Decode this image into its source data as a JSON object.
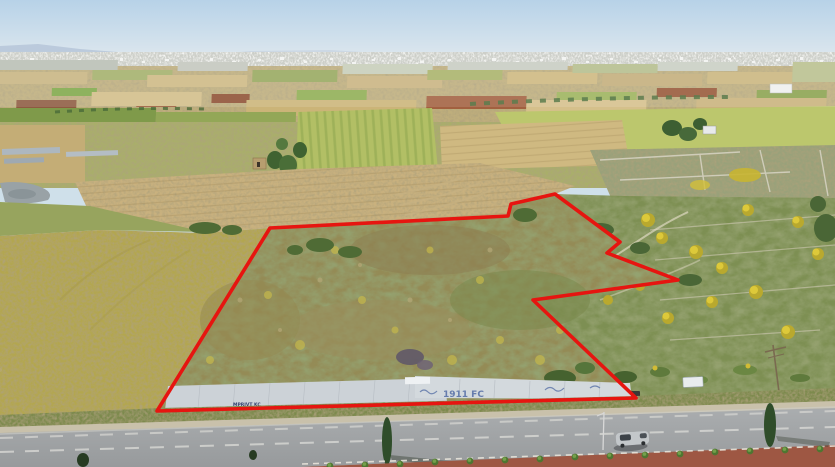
{
  "image": {
    "kind": "aerial-drone-photo",
    "subject": "aerial view of agricultural land plot outlined in red beside a main road",
    "width_px": 835,
    "height_px": 467
  },
  "colors": {
    "sky_top": "#b7d2e8",
    "sky_horizon": "#dde7ee",
    "mountains": "#b2c2d5",
    "distant_town": "#c6c9c2",
    "field_tan": "#c9b27c",
    "field_green": "#8fa754",
    "field_red_brown": "#9c5c3c",
    "meadow_yellow": "#b3a64f",
    "plot_scrub": "#948b56",
    "scrubland_green": "#7d8f52",
    "gorse_yellow": "#d6bf35",
    "wall_grey": "#ccd2d7",
    "road_grey": "#a2a5a7",
    "shoulder_tan": "#c9c1ab",
    "median_red": "#9e5743",
    "boundary_red": "#e61510",
    "lane_marking_white": "#dcdcd8",
    "car_silver": "#c3c7ca"
  },
  "plot_outline": {
    "color": "#e61510",
    "stroke_width": 3.6,
    "points": "157,411 270,228 508,216 511,204 555,194 620,242 607,253 678,280 533,300 636,398"
  },
  "graffiti": {
    "left_wall_text": "MPRIVT KC",
    "right_wall_text": "1911 FC"
  },
  "scene_objects": {
    "vehicle": "silver-minivan",
    "road": "asphalt-road-with-lane-dashes",
    "median": "red-paved-median-with-palm-shrubs",
    "wall": "grey-wall-with-graffiti",
    "horizon": "distant-town-and-mountains"
  }
}
